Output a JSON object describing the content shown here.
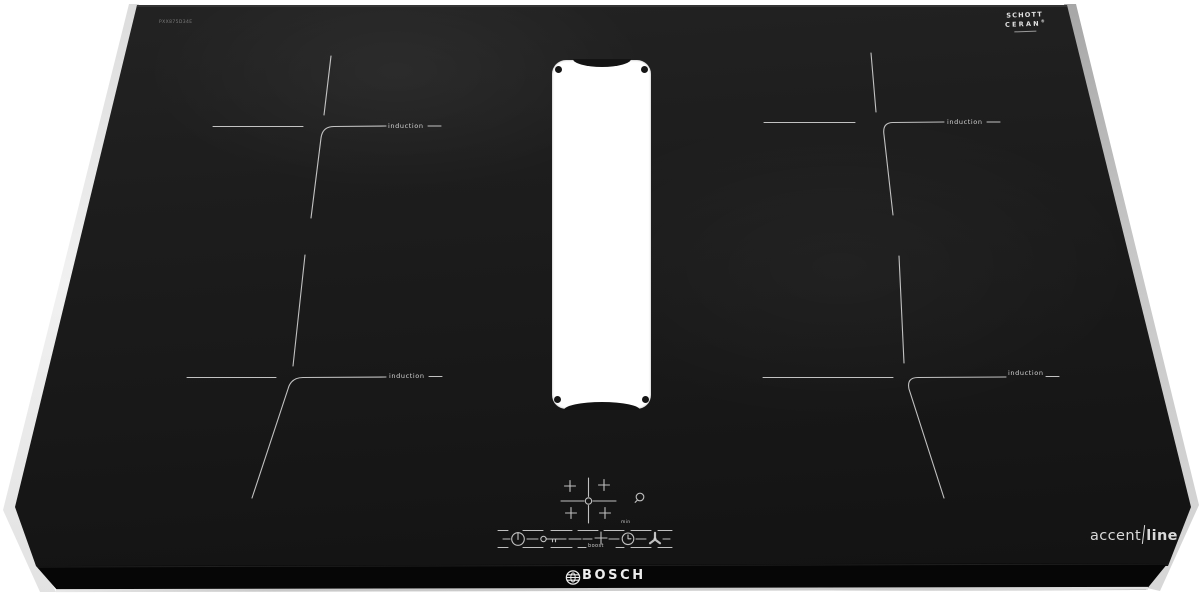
{
  "brand": {
    "name": "BOSCH"
  },
  "glass_logo": {
    "line1": "SCHOTT",
    "line2": "CERAN",
    "registered_mark": "®"
  },
  "series": {
    "part_light": "accent",
    "part_bold": "line"
  },
  "model_code": "PXX875D34E",
  "labels": {
    "induction": "induction",
    "boost": "boost",
    "min": "min"
  },
  "controls": {
    "power": "power-icon",
    "child_lock": "key-icon",
    "decrease": "minus-icon",
    "increase": "plus-icon",
    "timer": "clock-icon",
    "ventilation": "fan-icon",
    "alarm": "bell-icon",
    "zone_selector": "zone-cross-icon"
  },
  "colors": {
    "background": "#ffffff",
    "glass": "#1b1b1b",
    "front_edge": "#0b0b0b",
    "markings": "#d9d9d9",
    "left_bevel": "#ececec",
    "right_bevel": "#b9b9b9"
  }
}
